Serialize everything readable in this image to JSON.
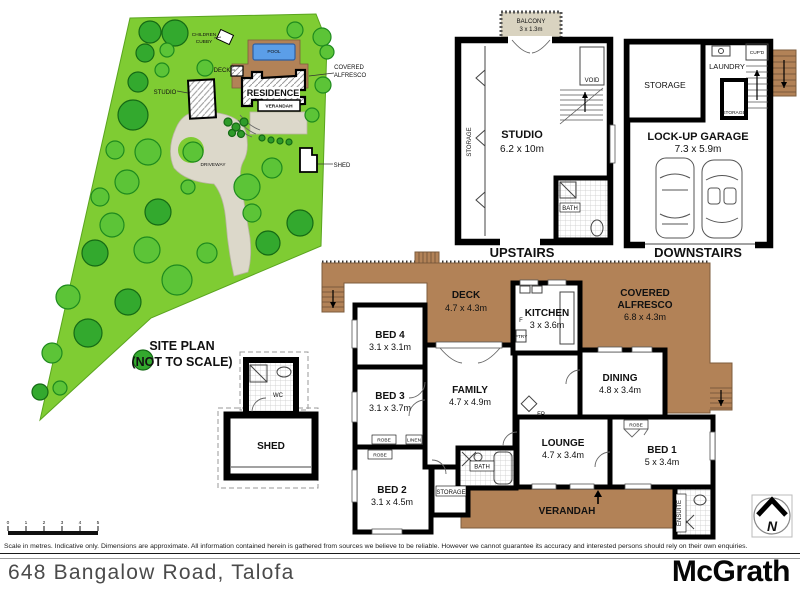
{
  "meta": {
    "address": "648 Bangalow Road, Talofa",
    "brand": "McGrath",
    "disclaimer": "Scale in metres. Indicative only. Dimensions are approximate. All information contained herein is gathered from sources we believe to be reliable. However we cannot guarantee its accuracy and interested persons should rely on their own enquiries.",
    "scale_ticks": [
      "0",
      "1",
      "2",
      "3",
      "4",
      "5"
    ]
  },
  "site": {
    "title1": "SITE PLAN",
    "title2": "(NOT TO SCALE)",
    "children1": "CHILDREN",
    "children2": "CUBBY",
    "pool": "POOL",
    "deck": "DECK",
    "alfresco1": "COVERED",
    "alfresco2": "ALFRESCO",
    "studio": "STUDIO",
    "residence": "RESIDENCE",
    "verandah": "VERANDAH",
    "driveway": "DRIVEWAY",
    "shed": "SHED"
  },
  "outbuilding": {
    "wc": "WC",
    "shed": "SHED"
  },
  "upstairs": {
    "caption": "UPSTAIRS",
    "balcony": "BALCONY",
    "balcony_dims": "3 x 1.3m",
    "studio": "STUDIO",
    "studio_dims": "6.2 x 10m",
    "void": "VOID",
    "bath": "BATH",
    "storage": "STORAGE"
  },
  "downstairs": {
    "caption": "DOWNSTAIRS",
    "storage": "STORAGE",
    "laundry": "LAUNDRY",
    "cupd": "CUP'D",
    "storage2": "STORAGE",
    "garage": "LOCK-UP GARAGE",
    "garage_dims": "7.3 x 5.9m"
  },
  "main": {
    "deck": "DECK",
    "deck_dims": "4.7 x 4.3m",
    "kitchen": "KITCHEN",
    "kitchen_dims": "3 x 3.6m",
    "alfresco1": "COVERED",
    "alfresco2": "ALFRESCO",
    "alfresco_dims": "6.8 x 4.3m",
    "bed4": "BED 4",
    "bed4_dims": "3.1 x 3.1m",
    "bed3": "BED 3",
    "bed3_dims": "3.1 x 3.7m",
    "bed2": "BED 2",
    "bed2_dims": "3.1 x 4.5m",
    "family": "FAMILY",
    "family_dims": "4.7 x 4.9m",
    "dining": "DINING",
    "dining_dims": "4.8 x 3.4m",
    "lounge": "LOUNGE",
    "lounge_dims": "4.7 x 3.4m",
    "bed1": "BED 1",
    "bed1_dims": "5 x 3.4m",
    "bath": "BATH",
    "storage": "STORAGE",
    "verandah": "VERANDAH",
    "ensuite": "ENSUITE",
    "robe": "ROBE",
    "linen": "LINEN",
    "fp": "FP",
    "fridge": "F",
    "pantry": "PTRY"
  },
  "compass": {
    "n": "N"
  },
  "colors": {
    "grass": "#7FCC33",
    "deck_brown": "#B28257",
    "pool_blue": "#5B9EE8",
    "balcony_beige": "#D9D3C0",
    "driveway": "#DCD8CA",
    "wall": "#000000"
  }
}
